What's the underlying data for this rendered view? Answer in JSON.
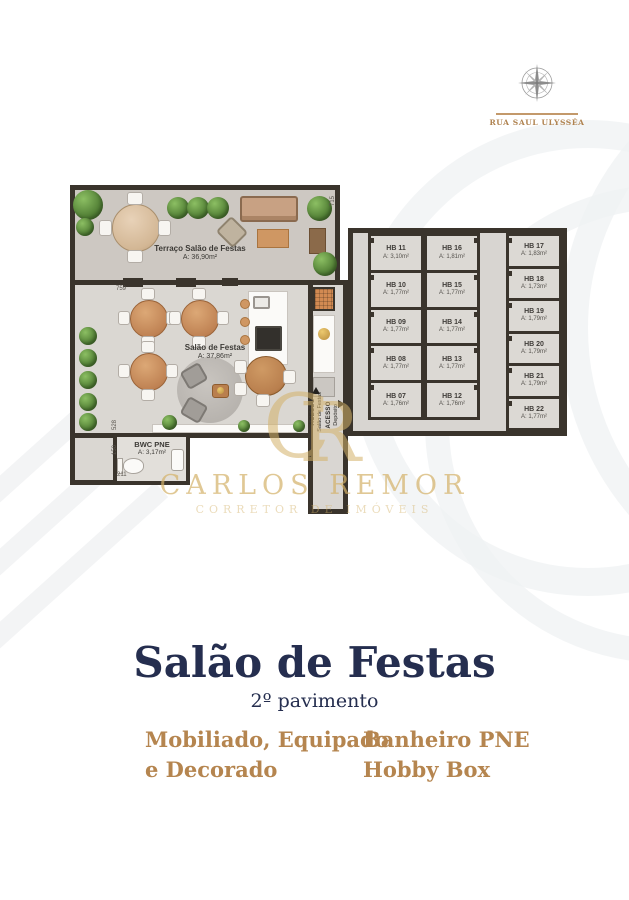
{
  "header": {
    "street": "RUA SAUL ULYSSÉA"
  },
  "watermark": {
    "monogram_c": "C",
    "monogram_r": "R",
    "name": "CARLOS REMOR",
    "tagline": "CORRETOR DE IMÓVEIS"
  },
  "floorplan": {
    "rooms": {
      "terrace": {
        "name": "Terraço Salão de Festas",
        "area": "A: 36,90m²"
      },
      "salon": {
        "name": "Salão de Festas",
        "area": "A: 37,86m²"
      },
      "bwc": {
        "name": "BWC PNE",
        "area": "A: 3,17m²"
      }
    },
    "access": {
      "salon": {
        "title": "ACESSO",
        "dest": "Salão de Festas"
      },
      "deposito": {
        "title": "ACESSO",
        "dest": "Depósito"
      }
    },
    "dims": {
      "d1": "759",
      "d2": "528",
      "d3": "150",
      "d4": "211",
      "d5": "715"
    },
    "hobby_boxes": {
      "col1": [
        {
          "name": "HB 11",
          "area": "A: 3,10m²"
        },
        {
          "name": "HB 10",
          "area": "A: 1,77m²"
        },
        {
          "name": "HB 09",
          "area": "A: 1,77m²"
        },
        {
          "name": "HB 08",
          "area": "A: 1,77m²"
        },
        {
          "name": "HB 07",
          "area": "A: 1,76m²"
        }
      ],
      "col2": [
        {
          "name": "HB 16",
          "area": "A: 1,81m²"
        },
        {
          "name": "HB 15",
          "area": "A: 1,77m²"
        },
        {
          "name": "HB 14",
          "area": "A: 1,77m²"
        },
        {
          "name": "HB 13",
          "area": "A: 1,77m²"
        },
        {
          "name": "HB 12",
          "area": "A: 1,76m²"
        }
      ],
      "col3": [
        {
          "name": "HB 17",
          "area": "A: 1,83m²"
        },
        {
          "name": "HB 18",
          "area": "A: 1,73m²"
        },
        {
          "name": "HB 19",
          "area": "A: 1,79m²"
        },
        {
          "name": "HB 20",
          "area": "A: 1,79m²"
        },
        {
          "name": "HB 21",
          "area": "A: 1,79m²"
        },
        {
          "name": "HB 22",
          "area": "A: 1,77m²"
        }
      ]
    }
  },
  "title_block": {
    "title": "Salão de Festas",
    "subtitle": "2º pavimento",
    "feature1_line1": "Mobiliado, Equipado",
    "feature1_line2": "e Decorado",
    "feature2_line1": "Banheiro PNE",
    "feature2_line2": "Hobby Box"
  },
  "colors": {
    "navy": "#252e4f",
    "tan": "#b5854f",
    "gold": "#d4b269",
    "wall": "#3a342c",
    "floor": "#dad7d2",
    "terrace_floor": "#cdc8c2",
    "wood": "#c68e5f",
    "plant_green": "#4f7c33"
  }
}
